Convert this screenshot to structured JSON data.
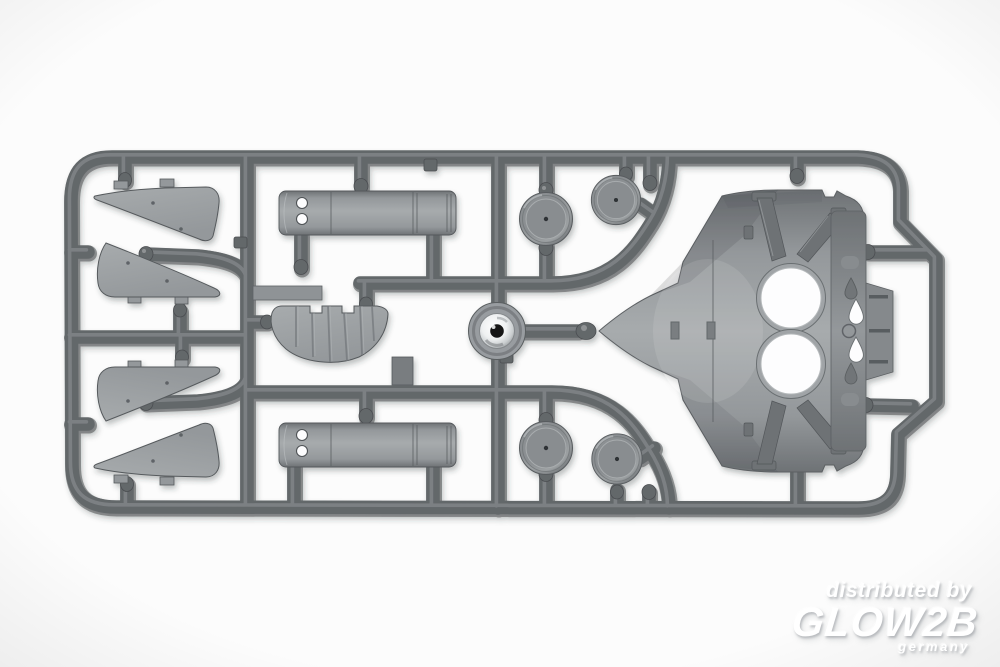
{
  "watermark": {
    "distributed_by": "distributed by",
    "brand": "GLOW2B",
    "country": "germany"
  },
  "colors": {
    "background": "#fcfcfc",
    "runner": "#64686b",
    "runner_highlight": "#909497",
    "runner_shadow": "#4b4e51",
    "part_light": "#a7abad",
    "part_mid": "#94989b",
    "part_dark": "#6e7275",
    "part_edge": "#565a5d",
    "hole_white": "#fdfdfe",
    "hole_dark": "#131516",
    "watermark_text": "#ffffff",
    "watermark_shadow": "#b9bdc0"
  }
}
